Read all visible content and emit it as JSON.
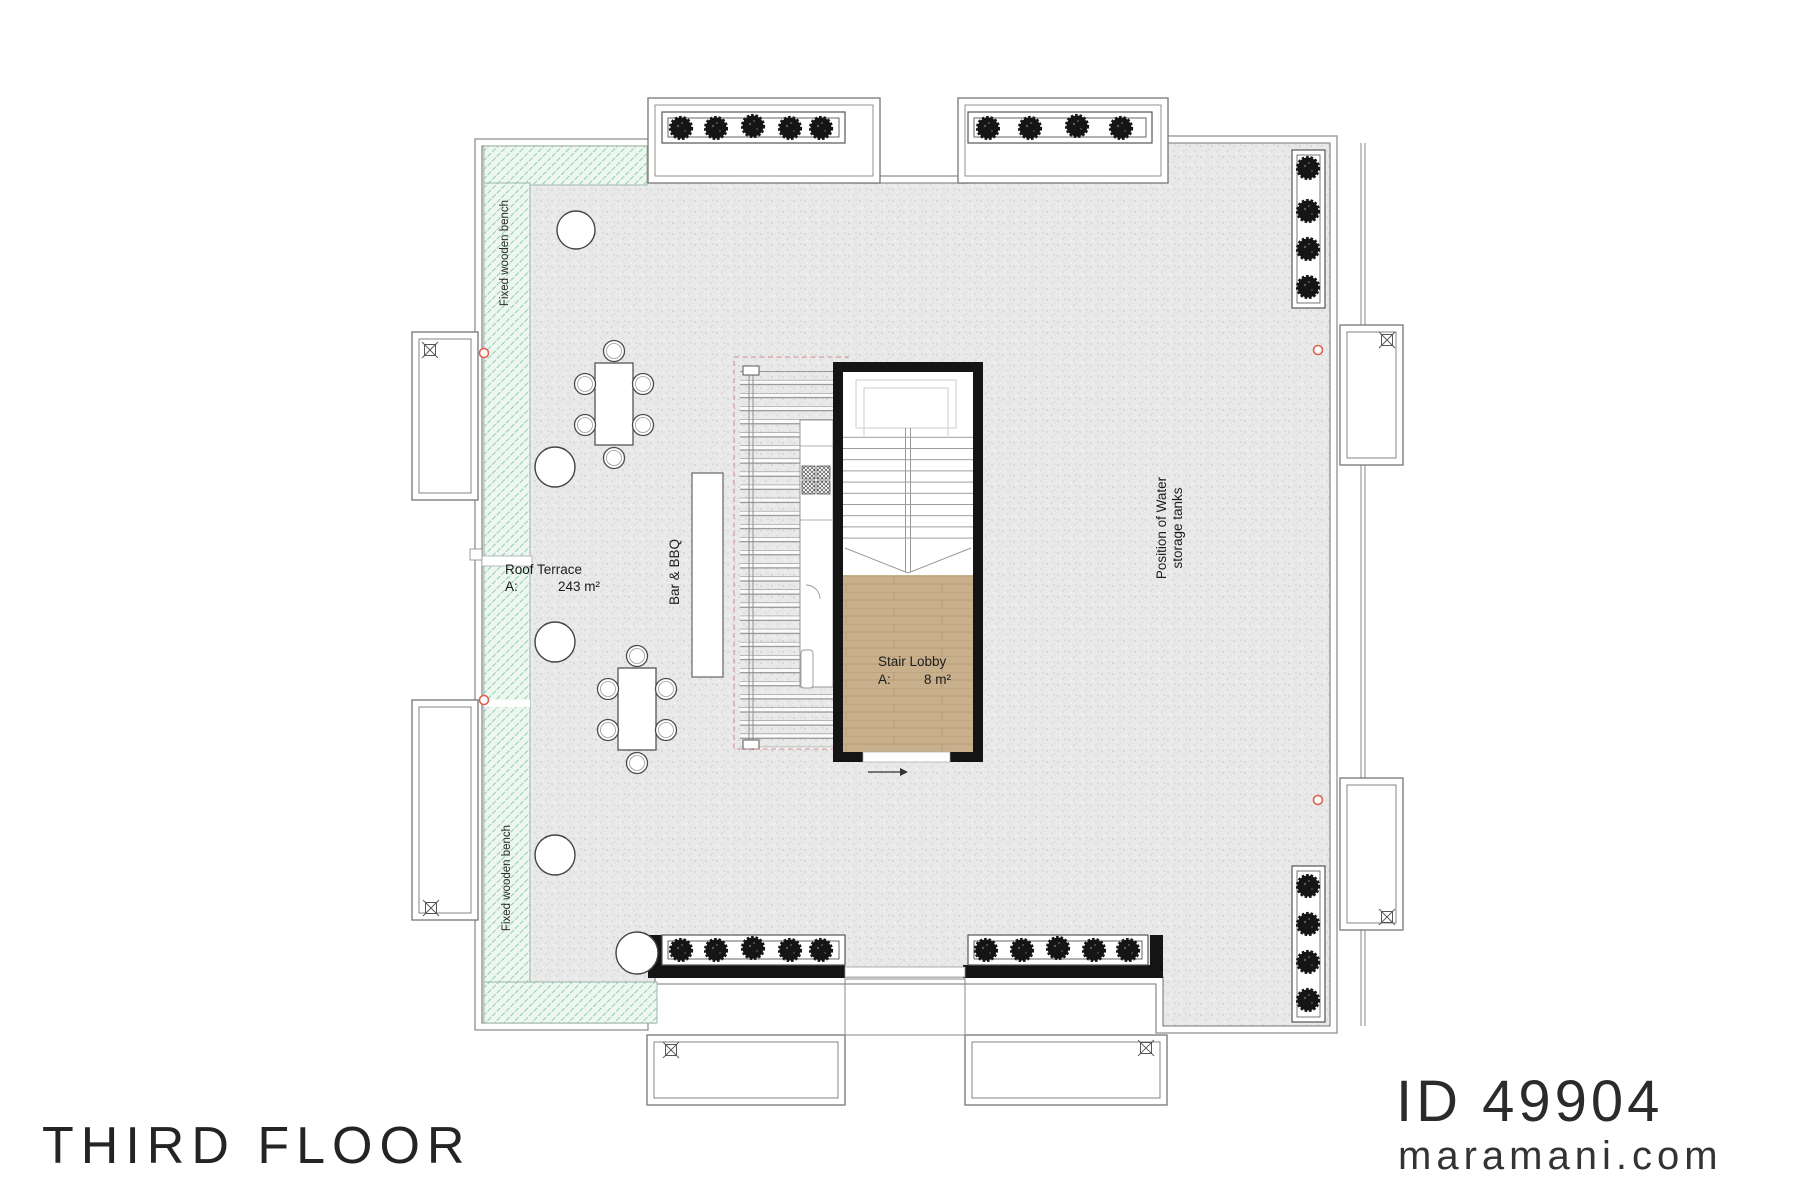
{
  "page": {
    "background": "#ffffff"
  },
  "title_block": {
    "floor_title": "THIRD FLOOR",
    "plan_id": "ID 49904",
    "website": "maramani.com"
  },
  "rooms": {
    "roof_terrace": {
      "name": "Roof Terrace",
      "area_prefix": "A:",
      "area_value": "243 m²"
    },
    "stair_lobby": {
      "name": "Stair Lobby",
      "area_prefix": "A:",
      "area_value": "8 m²"
    }
  },
  "annotations": {
    "bar_bbq": "Bar & BBQ",
    "water_tanks_line1": "Position of Water",
    "water_tanks_line2": "storage tanks",
    "fixed_bench_top": "Fixed wooden bench",
    "fixed_bench_bottom": "Fixed wooden bench"
  },
  "colors": {
    "bench_hatch_green": "#8ed0ab",
    "terrace_gray": "#e9e9e9",
    "lobby_wood": "#c9b08c",
    "stair_wall_black": "#141414",
    "drain_marker_red": "#e0604f",
    "pergola_dash_pink": "#cf8d8d"
  }
}
